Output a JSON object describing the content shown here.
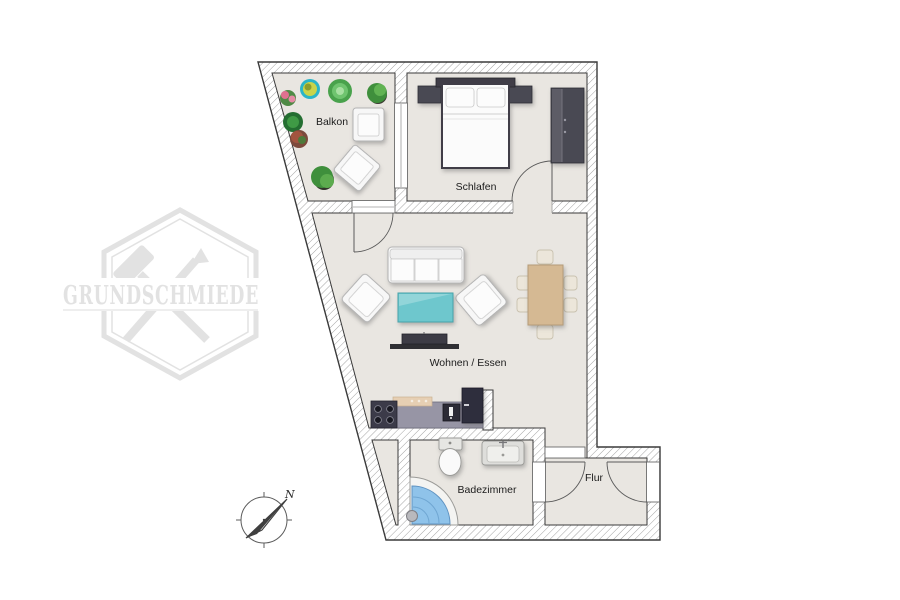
{
  "watermark": {
    "brand": "GRUNDSCHMIEDE"
  },
  "compass": {
    "north_label": "N"
  },
  "rooms": {
    "balcony": {
      "label": "Balkon"
    },
    "bedroom": {
      "label": "Schlafen"
    },
    "living": {
      "label": "Wohnen / Essen"
    },
    "bathroom": {
      "label": "Badezimmer"
    },
    "hallway": {
      "label": "Flur"
    }
  },
  "furniture": {
    "bedroom": [
      "double-bed",
      "pillows",
      "nightstand-left",
      "nightstand-right",
      "wardrobe"
    ],
    "living": [
      "sofa",
      "armchair-left",
      "armchair-right",
      "coffee-table",
      "tv-lowboard",
      "dining-table",
      "dining-chairs-x6"
    ],
    "kitchen": [
      "stove-4-burners",
      "counter",
      "kitchen-sink",
      "fridge"
    ],
    "bathroom": [
      "toilet",
      "washbasin",
      "corner-shower",
      "shower-head"
    ],
    "balcony": [
      "potted-plants-x7",
      "balcony-chair",
      "balcony-lounger"
    ]
  },
  "colors": {
    "floor": "#e9e6e1",
    "wall_outline": "#3a3a3a",
    "wall_hatch": "#9a9a9a",
    "coffee_table_teal": "#6ec7cd",
    "shower_blue": "#8fc3ea",
    "dining_wood": "#d5b993",
    "dark_furniture": "#4a4953",
    "watermark_gray": "#e2e2e2"
  }
}
